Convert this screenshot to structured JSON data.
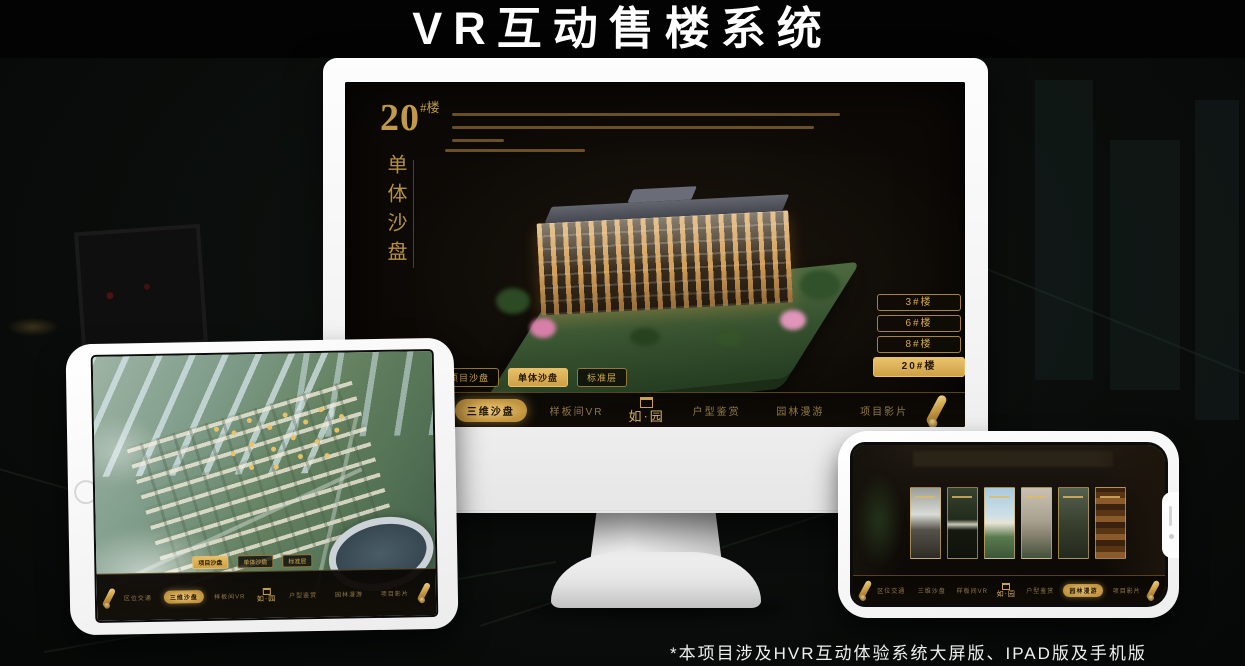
{
  "title": "VR互动售楼系统",
  "footnote": "*本项目涉及HVR互动体验系统大屏版、IPAD版及手机版",
  "brand": {
    "logo_text": "如·园"
  },
  "colors": {
    "gold": "#d2a94f",
    "gold_selected": "#e0b55e",
    "screen_bg": "#0c0906"
  },
  "shared": {
    "sandbox_tabs": [
      "项目沙盘",
      "单体沙盘",
      "标准层"
    ],
    "nav_items": [
      "区位交通",
      "三维沙盘",
      "样板间VR",
      "户型鉴赏",
      "园林漫游",
      "项目影片"
    ]
  },
  "desktop": {
    "building_number": "20",
    "building_unit": "#楼",
    "building_subtitle": "单体沙盘",
    "floor_buttons": [
      {
        "label": "3#楼",
        "selected": false
      },
      {
        "label": "6#楼",
        "selected": false
      },
      {
        "label": "8#楼",
        "selected": false
      },
      {
        "label": "20#楼",
        "selected": true
      }
    ],
    "selected_tab": "单体沙盘",
    "selected_nav_item": "三维沙盘"
  },
  "tablet": {
    "selected_tab": "项目沙盘",
    "selected_nav_item": "三维沙盘"
  },
  "phone": {
    "selected_nav_item": "园林漫游"
  }
}
